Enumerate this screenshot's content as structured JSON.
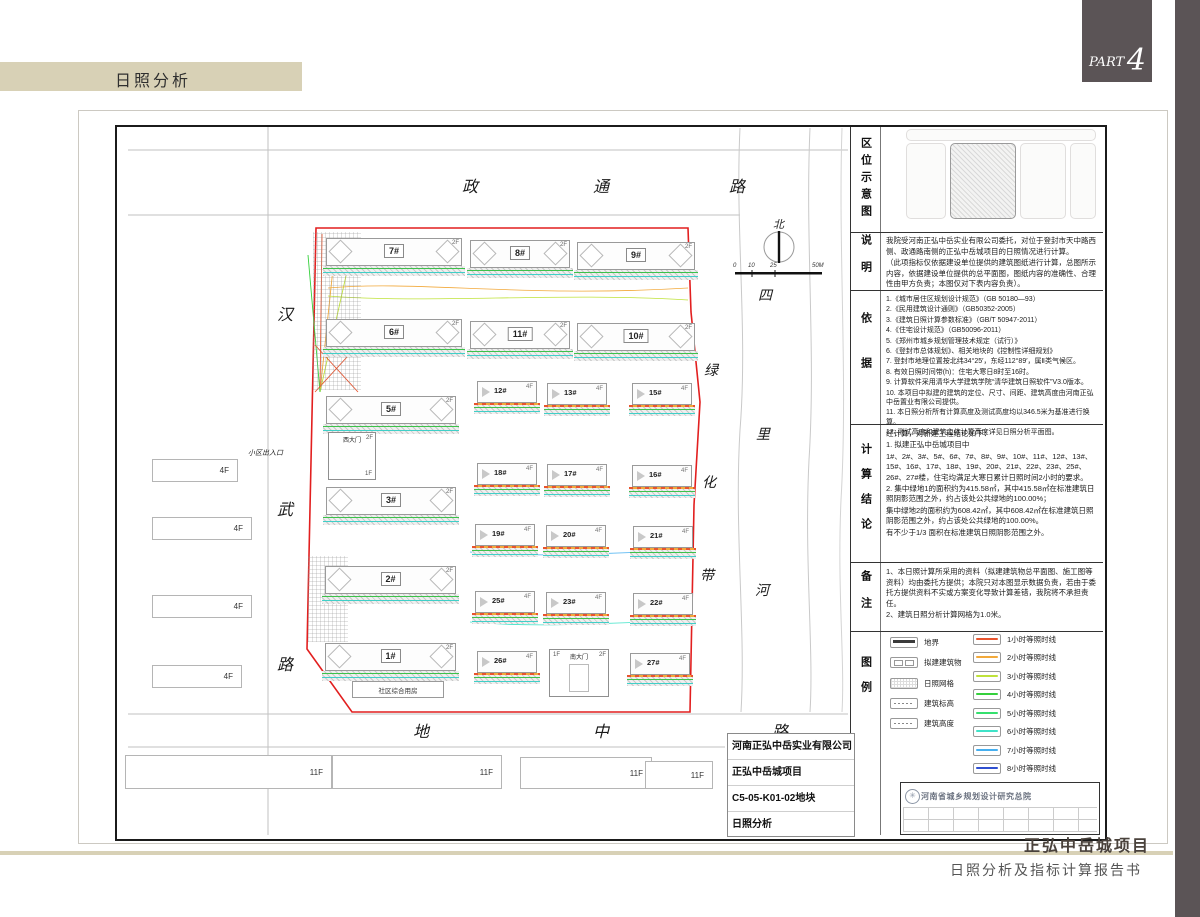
{
  "header": {
    "page_title": "日照分析",
    "part_word": "PART",
    "part_number": "4"
  },
  "footer": {
    "project": "正弘中岳城项目",
    "report": "日照分析及指标计算报告书"
  },
  "title_block": {
    "company": "河南正弘中岳实业有限公司",
    "project": "正弘中岳城项目",
    "plot": "C5-05-K01-02地块",
    "drawing": "日照分析"
  },
  "stamp": {
    "institute": "河南省城乡规划设计研究总院"
  },
  "plan": {
    "roads": {
      "top": [
        "政",
        "通",
        "路"
      ],
      "left": [
        "汉",
        "武",
        "路"
      ],
      "bottom": [
        "地",
        "中",
        "路"
      ],
      "river": [
        "四",
        "里",
        "河"
      ],
      "greenbelt": [
        "绿",
        "化",
        "带"
      ]
    },
    "north": "北",
    "scale": [
      "0",
      "10",
      "25",
      "50M"
    ],
    "entrance": "小区出入口",
    "community": "社区综合用房",
    "west_gate": "西大门",
    "south_gate": "南大门",
    "gate_f1": "1F",
    "gate_f2": "2F",
    "annex_floor": "2F",
    "tower_floor": "4F",
    "west_floor": "4F",
    "south_floor": "11F",
    "buildings": {
      "b1": "1#",
      "b2": "2#",
      "b3": "3#",
      "b5": "5#",
      "b6": "6#",
      "b7": "7#",
      "b8": "8#",
      "b9": "9#",
      "b10": "10#",
      "b11": "11#",
      "b12": "12#",
      "b13": "13#",
      "b15": "15#",
      "b16": "16#",
      "b17": "17#",
      "b18": "18#",
      "b19": "19#",
      "b20": "20#",
      "b21": "21#",
      "b22": "22#",
      "b23": "23#",
      "b25": "25#",
      "b26": "26#",
      "b27": "27#"
    }
  },
  "panel": {
    "sections": {
      "location": "区位示意图",
      "notes": "说明",
      "basis": "依据",
      "conclusion": "计算结论",
      "remarks": "备注",
      "legend": "图例"
    },
    "statement": {
      "p1": "我院受河南正弘中岳实业有限公司委托，对位于登封市天中路西侧、政通路南侧的正弘中岳城项目的日照情况进行计算。",
      "p2": "（此项指标仅依据建设单位提供的建筑图纸进行计算，总图所示内容，依据建设单位提供的总平面图，图纸内容的准确性、合理性由甲方负责；本图仅对下表内容负责）。"
    },
    "basis": {
      "items": [
        "1.《城市居住区规划设计规范》（GB 50180—93）",
        "2.《民用建筑设计通则》（GB50352-2005）",
        "3.《建筑日照计算参数标准》（GB/T 50947-2011）",
        "4.《住宅设计规范》（GB50096-2011）",
        "5.《郑州市城乡规划管理技术规定（试行）》",
        "6.《登封市总体规划》、相关地块的《控制性详细规划》",
        "7. 登封市地理位置按北纬34°25′，东经112°89′，属Ⅱ类气候区。",
        "8. 有效日照时间带(h)：住宅大寒日8时至16时。",
        "9. 计算软件采用清华大学建筑学院“清华建筑日照软件”V3.0版本。",
        "10. 本项目中拟建的建筑的定位、尺寸、间距、建筑高度由河南正弘中岳置业有限公司提供。",
        "11. 本日照分析所有计算高度及测试高度均以346.5米为基准进行换算。",
        "12. 测试高度和建筑主体计算高度详见日照分析平面图。"
      ]
    },
    "conclusion": {
      "lines": [
        "经计算，对新建工程结论如下：",
        "1. 拟建正弘中岳城项目中",
        "1#、2#、3#、5#、6#、7#、8#、9#、10#、11#、12#、13#、15#、16#、17#、18#、19#、20#、21#、22#、23#、25#、26#、27#楼，住宅均满足大寒日累计日照时间2小时的要求。",
        "2. 集中绿地1的面积约为415.58㎡，其中415.58㎡在标准建筑日照阴影范围之外，约占该处公共绿地的100.00%；",
        "集中绿地2的面积约为608.42㎡，其中608.42㎡在标准建筑日照阴影范围之外，约占该处公共绿地的100.00%。",
        "有不少于1/3 面积在标准建筑日照阴影范围之外。"
      ]
    },
    "remarks": {
      "items": [
        "1、本日照计算所采用的资料（拟建建筑物总平面图、施工图等资料）均由委托方提供；本院只对本图显示数据负责，若由于委托方提供资料不实或方案变化导致计算差错，我院将不承担责任。",
        "2、建筑日照分析计算网格为1.0米。"
      ]
    },
    "legend": {
      "left": [
        {
          "label": "地界"
        },
        {
          "label": "拟建建筑物"
        },
        {
          "label": "日照网格"
        },
        {
          "label": "建筑标高"
        },
        {
          "label": "建筑高度"
        }
      ],
      "right": [
        {
          "label": "1小时等照时线",
          "color": "#e8542e"
        },
        {
          "label": "2小时等照时线",
          "color": "#f2a93b"
        },
        {
          "label": "3小时等照时线",
          "color": "#bfe23a"
        },
        {
          "label": "4小时等照时线",
          "color": "#35d03c"
        },
        {
          "label": "5小时等照时线",
          "color": "#35e06e"
        },
        {
          "label": "6小时等照时线",
          "color": "#3fe3c8"
        },
        {
          "label": "7小时等照时线",
          "color": "#45aff0"
        },
        {
          "label": "8小时等照时线",
          "color": "#2f4fd0"
        }
      ]
    }
  },
  "colors": {
    "accent_beige": "#d8d1b6",
    "dark_bar": "#5b5456",
    "boundary_red": "#e21f1f"
  }
}
